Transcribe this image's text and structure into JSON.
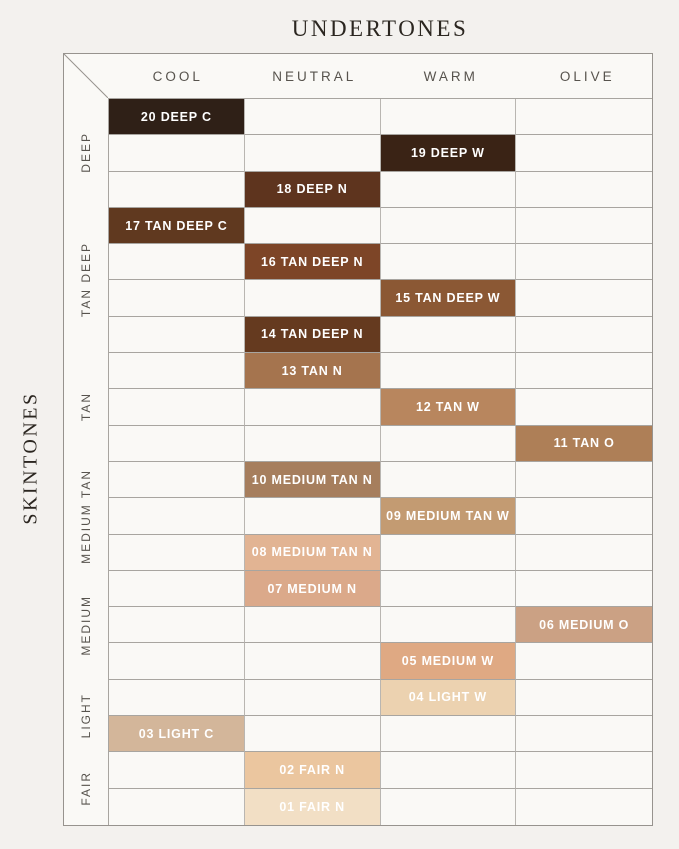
{
  "title": "UNDERTONES",
  "left_axis_label": "SKINTONES",
  "header": {
    "columns": [
      "COOL",
      "NEUTRAL",
      "WARM",
      "OLIVE"
    ]
  },
  "groups": [
    {
      "label": "DEEP",
      "rows": 3
    },
    {
      "label": "TAN DEEP",
      "rows": 4
    },
    {
      "label": "TAN",
      "rows": 3
    },
    {
      "label": "MEDIUM TAN",
      "rows": 3
    },
    {
      "label": "MEDIUM",
      "rows": 3
    },
    {
      "label": "LIGHT",
      "rows": 2
    },
    {
      "label": "FAIR",
      "rows": 2
    }
  ],
  "colors": {
    "page_background": "#f3f1ee",
    "cell_background": "#faf9f6",
    "gridline": "#a8a5a0",
    "outer_border": "#97938e",
    "header_text": "#57534d",
    "group_label_text": "#57534d",
    "title_text": "#2b2620",
    "shade_text": "#ffffff"
  },
  "chart_data": {
    "type": "heatmap",
    "title": "UNDERTONES",
    "x_axis": {
      "label": "UNDERTONES",
      "categories": [
        "COOL",
        "NEUTRAL",
        "WARM",
        "OLIVE"
      ]
    },
    "y_axis": {
      "label": "SKINTONES",
      "groups": [
        "DEEP",
        "TAN DEEP",
        "TAN",
        "MEDIUM TAN",
        "MEDIUM",
        "LIGHT",
        "FAIR"
      ],
      "rows": 20
    },
    "grid": {
      "rows": 20,
      "columns": 4,
      "gridlines": true,
      "legend": "none"
    },
    "cells": [
      {
        "row": 1,
        "group": "DEEP",
        "undertone": "COOL",
        "shade": "20 DEEP C",
        "color": "#2f2017"
      },
      {
        "row": 2,
        "group": "DEEP",
        "undertone": "WARM",
        "shade": "19 DEEP W",
        "color": "#3a2315"
      },
      {
        "row": 3,
        "group": "DEEP",
        "undertone": "NEUTRAL",
        "shade": "18 DEEP N",
        "color": "#5e341e"
      },
      {
        "row": 4,
        "group": "TAN DEEP",
        "undertone": "COOL",
        "shade": "17 TAN DEEP C",
        "color": "#60391f"
      },
      {
        "row": 5,
        "group": "TAN DEEP",
        "undertone": "NEUTRAL",
        "shade": "16 TAN DEEP N",
        "color": "#7d4527"
      },
      {
        "row": 6,
        "group": "TAN DEEP",
        "undertone": "WARM",
        "shade": "15 TAN DEEP W",
        "color": "#8b5834"
      },
      {
        "row": 7,
        "group": "TAN DEEP",
        "undertone": "NEUTRAL",
        "shade": "14 TAN DEEP N",
        "color": "#653a1f"
      },
      {
        "row": 8,
        "group": "TAN",
        "undertone": "NEUTRAL",
        "shade": "13 TAN N",
        "color": "#a5744e"
      },
      {
        "row": 9,
        "group": "TAN",
        "undertone": "WARM",
        "shade": "12 TAN W",
        "color": "#b8865e"
      },
      {
        "row": 10,
        "group": "TAN",
        "undertone": "OLIVE",
        "shade": "11 TAN O",
        "color": "#ae7f57"
      },
      {
        "row": 11,
        "group": "MEDIUM TAN",
        "undertone": "NEUTRAL",
        "shade": "10 MEDIUM TAN N",
        "color": "#a67e5d"
      },
      {
        "row": 12,
        "group": "MEDIUM TAN",
        "undertone": "WARM",
        "shade": "09 MEDIUM TAN W",
        "color": "#c39b72"
      },
      {
        "row": 13,
        "group": "MEDIUM TAN",
        "undertone": "NEUTRAL",
        "shade": "08 MEDIUM TAN N",
        "color": "#e2b493"
      },
      {
        "row": 14,
        "group": "MEDIUM",
        "undertone": "NEUTRAL",
        "shade": "07 MEDIUM N",
        "color": "#dba98a"
      },
      {
        "row": 15,
        "group": "MEDIUM",
        "undertone": "OLIVE",
        "shade": "06 MEDIUM O",
        "color": "#cba184"
      },
      {
        "row": 16,
        "group": "MEDIUM",
        "undertone": "WARM",
        "shade": "05 MEDIUM W",
        "color": "#dfa983"
      },
      {
        "row": 17,
        "group": "LIGHT",
        "undertone": "WARM",
        "shade": "04 LIGHT W",
        "color": "#ecd2b0"
      },
      {
        "row": 18,
        "group": "LIGHT",
        "undertone": "COOL",
        "shade": "03 LIGHT C",
        "color": "#d3b69a"
      },
      {
        "row": 19,
        "group": "FAIR",
        "undertone": "NEUTRAL",
        "shade": "02 FAIR N",
        "color": "#ebc69f"
      },
      {
        "row": 20,
        "group": "FAIR",
        "undertone": "NEUTRAL",
        "shade": "01 FAIR N",
        "color": "#f2dfc5"
      }
    ]
  }
}
